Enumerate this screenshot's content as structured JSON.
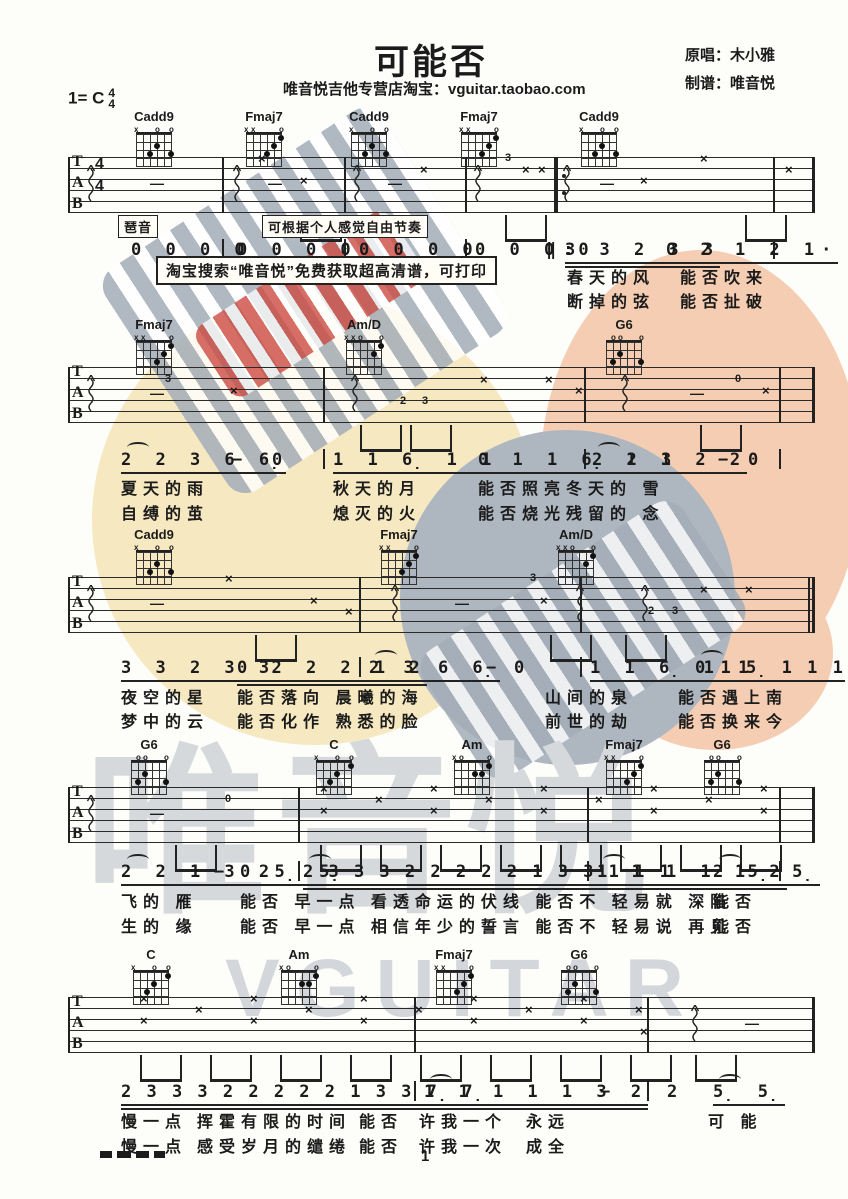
{
  "header": {
    "title": "可能否",
    "key_prefix": "1= C",
    "time_top": "4",
    "time_bottom": "4",
    "subtitle": "唯音悦吉他专营店淘宝：vguitar.taobao.com",
    "credit_singer": "原唱：木小雅",
    "credit_arranger": "制谱：唯音悦"
  },
  "labels": {
    "arpeggio": "琶音",
    "free_rhythm": "可根据个人感觉自由节奏",
    "banner": "淘宝搜索“唯音悦”免费获取超高清谱，可打印",
    "page_number": "1"
  },
  "watermark": {
    "cn": "唯音悦",
    "en": "VGUITAR",
    "colors": {
      "yellow": "#f6e8c0",
      "salmon": "#f5cdb2",
      "gray_circle": "#aeb6c0",
      "stripe": "#a3adb8",
      "red": "#cc4b42",
      "big_text": "#d6d9dc"
    }
  },
  "chord_defs": {
    "Cadd9": {
      "markers": [
        "x",
        "",
        "",
        "o",
        "",
        "o"
      ],
      "dots": [
        [
          2,
          3
        ],
        [
          3,
          2
        ],
        [
          5,
          3
        ]
      ]
    },
    "Fmaj7": {
      "markers": [
        "x",
        "x",
        "",
        "",
        "",
        "o"
      ],
      "dots": [
        [
          3,
          3
        ],
        [
          4,
          2
        ],
        [
          5,
          1
        ]
      ]
    },
    "Am/D": {
      "markers": [
        "x",
        "x",
        "o",
        "",
        "",
        "o"
      ],
      "dots": [
        [
          4,
          2
        ],
        [
          5,
          1
        ]
      ]
    },
    "G6": {
      "markers": [
        "",
        "o",
        "o",
        "",
        "",
        "o"
      ],
      "dots": [
        [
          1,
          3
        ],
        [
          2,
          2
        ],
        [
          5,
          3
        ]
      ]
    },
    "C": {
      "markers": [
        "x",
        "",
        "",
        "o",
        "",
        "o"
      ],
      "dots": [
        [
          2,
          3
        ],
        [
          3,
          2
        ],
        [
          5,
          1
        ]
      ]
    },
    "Am": {
      "markers": [
        "x",
        "o",
        "",
        "",
        "",
        "o"
      ],
      "dots": [
        [
          3,
          2
        ],
        [
          4,
          2
        ],
        [
          5,
          1
        ]
      ]
    }
  },
  "systems": [
    {
      "chordTop": 110,
      "staffTop": 157,
      "numTop": 240,
      "lyrTop1": 264,
      "lyrTop2": 288,
      "timeSig": true,
      "chords": [
        {
          "n": "Cadd9",
          "x": 130
        },
        {
          "n": "Fmaj7",
          "x": 240
        },
        {
          "n": "Cadd9",
          "x": 345
        },
        {
          "n": "Fmaj7",
          "x": 455
        },
        {
          "n": "Cadd9",
          "x": 575
        }
      ],
      "bars": [
        68,
        222,
        344,
        465,
        773
      ],
      "endX": 812,
      "repeatX": 554,
      "marks": [
        {
          "t": "sq",
          "x": 86
        },
        {
          "t": "sq",
          "x": 232
        },
        {
          "t": "sq",
          "x": 352
        },
        {
          "t": "sq",
          "x": 473
        },
        {
          "t": "sq",
          "x": 562
        },
        {
          "t": "x",
          "x": 258,
          "l": 0
        },
        {
          "t": "x",
          "x": 300,
          "l": 2
        },
        {
          "t": "d",
          "x": 150,
          "l": 2
        },
        {
          "t": "d",
          "x": 268,
          "l": 2
        },
        {
          "t": "d",
          "x": 388,
          "l": 2
        },
        {
          "t": "x",
          "x": 420,
          "l": 1
        },
        {
          "t": "g",
          "x": 505,
          "l": 0,
          "v": "3"
        },
        {
          "t": "x",
          "x": 522,
          "l": 1
        },
        {
          "t": "x",
          "x": 538,
          "l": 1
        },
        {
          "t": "d",
          "x": 600,
          "l": 2
        },
        {
          "t": "x",
          "x": 640,
          "l": 2
        },
        {
          "t": "x",
          "x": 700,
          "l": 0
        },
        {
          "t": "x",
          "x": 785,
          "l": 1
        }
      ],
      "beams": [
        300,
        505,
        745
      ],
      "numBars": [
        222,
        344,
        465,
        773
      ],
      "groups": [
        {
          "x": 131,
          "t": "0 0 0 0"
        },
        {
          "x": 237,
          "t": "0 0 0 0"
        },
        {
          "x": 359,
          "t": "0 0 0 0"
        },
        {
          "x": 475,
          "t": "0 0 0 0"
        },
        {
          "x": 546,
          "t": "‖:"
        },
        {
          "x": 565,
          "t": "3 3 2 3 3",
          "u": 2
        },
        {
          "x": 666,
          "t": "0 2 1 2 1·",
          "u": 1
        }
      ],
      "lyr1": [
        {
          "x": 567,
          "t": "春天的风"
        },
        {
          "x": 680,
          "t": "能否吹来"
        }
      ],
      "lyr2": [
        {
          "x": 567,
          "t": "断掉的弦"
        },
        {
          "x": 680,
          "t": "能否扯破"
        }
      ]
    },
    {
      "chordTop": 318,
      "staffTop": 367,
      "numTop": 450,
      "lyrTop1": 475,
      "lyrTop2": 500,
      "chords": [
        {
          "n": "Fmaj7",
          "x": 130
        },
        {
          "n": "Am/D",
          "x": 340
        },
        {
          "n": "G6",
          "x": 600
        }
      ],
      "bars": [
        68,
        323,
        584,
        779
      ],
      "endX": 812,
      "marks": [
        {
          "t": "sq",
          "x": 86
        },
        {
          "t": "g",
          "x": 165,
          "l": 1,
          "v": "3"
        },
        {
          "t": "d",
          "x": 150,
          "l": 2
        },
        {
          "t": "x",
          "x": 230,
          "l": 2
        },
        {
          "t": "sq",
          "x": 350
        },
        {
          "t": "g",
          "x": 400,
          "l": 3,
          "v": "2"
        },
        {
          "t": "g",
          "x": 422,
          "l": 3,
          "v": "3"
        },
        {
          "t": "x",
          "x": 480,
          "l": 1
        },
        {
          "t": "x",
          "x": 545,
          "l": 1
        },
        {
          "t": "x",
          "x": 575,
          "l": 2
        },
        {
          "t": "sq",
          "x": 620
        },
        {
          "t": "d",
          "x": 690,
          "l": 2
        },
        {
          "t": "g",
          "x": 735,
          "l": 1,
          "v": "0"
        },
        {
          "t": "x",
          "x": 762,
          "l": 2
        }
      ],
      "beams": [
        360,
        410,
        700
      ],
      "numBars": [
        323,
        584,
        779
      ],
      "groups": [
        {
          "x": 121,
          "t": "2 2 3 6 6̣",
          "u": 1,
          "arc": true
        },
        {
          "x": 232,
          "t": "−"
        },
        {
          "x": 272,
          "t": "0"
        },
        {
          "x": 333,
          "t": "1 1 6̣ 1 1",
          "u": 1
        },
        {
          "x": 478,
          "t": "0 1 1 6̣ 1 1",
          "u": 1
        },
        {
          "x": 592,
          "t": "2 2 3 2 2",
          "u": 1,
          "arc": true
        },
        {
          "x": 718,
          "t": "−"
        },
        {
          "x": 748,
          "t": "0"
        }
      ],
      "lyr1": [
        {
          "x": 121,
          "t": "夏天的雨"
        },
        {
          "x": 333,
          "t": "秋天的月"
        },
        {
          "x": 478,
          "t": "能否照亮冬天的 雪"
        }
      ],
      "lyr2": [
        {
          "x": 121,
          "t": "自缚的茧"
        },
        {
          "x": 333,
          "t": "熄灭的火"
        },
        {
          "x": 478,
          "t": "能否烧光残留的 念"
        }
      ]
    },
    {
      "chordTop": 528,
      "staffTop": 577,
      "numTop": 658,
      "lyrTop1": 684,
      "lyrTop2": 708,
      "chords": [
        {
          "n": "Cadd9",
          "x": 130
        },
        {
          "n": "Fmaj7",
          "x": 375
        },
        {
          "n": "Am/D",
          "x": 552
        }
      ],
      "bars": [
        68,
        359,
        580,
        808
      ],
      "endX": 812,
      "marks": [
        {
          "t": "sq",
          "x": 86
        },
        {
          "t": "d",
          "x": 150,
          "l": 2
        },
        {
          "t": "x",
          "x": 225,
          "l": 0
        },
        {
          "t": "x",
          "x": 310,
          "l": 2
        },
        {
          "t": "x",
          "x": 345,
          "l": 3
        },
        {
          "t": "sq",
          "x": 390
        },
        {
          "t": "d",
          "x": 455,
          "l": 2
        },
        {
          "t": "g",
          "x": 530,
          "l": 0,
          "v": "3"
        },
        {
          "t": "x",
          "x": 540,
          "l": 2
        },
        {
          "t": "sq",
          "x": 575
        },
        {
          "t": "sq",
          "x": 640
        },
        {
          "t": "g",
          "x": 648,
          "l": 3,
          "v": "2"
        },
        {
          "t": "g",
          "x": 672,
          "l": 3,
          "v": "3"
        },
        {
          "t": "x",
          "x": 700,
          "l": 1
        },
        {
          "t": "x",
          "x": 745,
          "l": 1
        }
      ],
      "beams": [
        255,
        550,
        625
      ],
      "numBars": [
        359,
        580
      ],
      "groups": [
        {
          "x": 121,
          "t": "3 3 2 3 3",
          "u": 1
        },
        {
          "x": 237,
          "t": "0 2 2 2 1 2",
          "u": 2
        },
        {
          "x": 369,
          "t": "2 3 6 6̣",
          "u": 1,
          "arc": true
        },
        {
          "x": 486,
          "t": "−"
        },
        {
          "x": 514,
          "t": "0"
        },
        {
          "x": 590,
          "t": "1 1 6̣ 1 1",
          "u": 1
        },
        {
          "x": 695,
          "t": "0 1 5̣ 1 1 1",
          "u": 1,
          "tight": true,
          "arc": true
        }
      ],
      "lyr1": [
        {
          "x": 121,
          "t": "夜空的星"
        },
        {
          "x": 237,
          "t": "能否落向 晨曦的海"
        },
        {
          "x": 545,
          "t": "山间的泉"
        },
        {
          "x": 678,
          "t": "能否遇上南"
        }
      ],
      "lyr2": [
        {
          "x": 121,
          "t": "梦中的云"
        },
        {
          "x": 237,
          "t": "能否化作 熟悉的脸"
        },
        {
          "x": 545,
          "t": "前世的劫"
        },
        {
          "x": 678,
          "t": "能否换来今"
        }
      ]
    },
    {
      "chordTop": 738,
      "staffTop": 787,
      "numTop": 862,
      "lyrTop1": 888,
      "lyrTop2": 913,
      "chords": [
        {
          "n": "G6",
          "x": 125
        },
        {
          "n": "C",
          "x": 310
        },
        {
          "n": "Am",
          "x": 448
        },
        {
          "n": "Fmaj7",
          "x": 600
        },
        {
          "n": "G6",
          "x": 698
        }
      ],
      "bars": [
        68,
        298,
        587,
        779
      ],
      "endX": 812,
      "marks": [
        {
          "t": "sq",
          "x": 86
        },
        {
          "t": "d",
          "x": 150,
          "l": 2
        },
        {
          "t": "g",
          "x": 225,
          "l": 1,
          "v": "0"
        },
        {
          "t": "x",
          "x": 320,
          "l": 0
        },
        {
          "t": "x",
          "x": 320,
          "l": 2
        },
        {
          "t": "x",
          "x": 375,
          "l": 1
        },
        {
          "t": "x",
          "x": 430,
          "l": 0
        },
        {
          "t": "x",
          "x": 430,
          "l": 2
        },
        {
          "t": "x",
          "x": 485,
          "l": 1
        },
        {
          "t": "x",
          "x": 540,
          "l": 0
        },
        {
          "t": "x",
          "x": 540,
          "l": 2
        },
        {
          "t": "x",
          "x": 595,
          "l": 1
        },
        {
          "t": "x",
          "x": 650,
          "l": 0
        },
        {
          "t": "x",
          "x": 650,
          "l": 2
        },
        {
          "t": "x",
          "x": 705,
          "l": 1
        },
        {
          "t": "x",
          "x": 760,
          "l": 0
        },
        {
          "t": "x",
          "x": 760,
          "l": 2
        }
      ],
      "beams": [
        175,
        320,
        380,
        440,
        500,
        560,
        620,
        680,
        740
      ],
      "numBars": [
        298,
        587,
        779
      ],
      "groups": [
        {
          "x": 121,
          "t": "2 2 1 3 2",
          "u": 1,
          "arc": true
        },
        {
          "x": 214,
          "t": "−"
        },
        {
          "x": 240,
          "t": "0 5̣ 5̣",
          "u": 1
        },
        {
          "x": 303,
          "t": "2 3 3 3 2 2 2 2 2 1 3 3 1 1 1",
          "u": 2,
          "tight": true,
          "arc": true
        },
        {
          "x": 597,
          "t": "1 1 1 1 1 2",
          "u": 2,
          "arc": true
        },
        {
          "x": 713,
          "t": "2 5̣ 5̣",
          "u": 1,
          "arc": true
        }
      ],
      "lyr1": [
        {
          "x": 121,
          "t": "飞的 雁"
        },
        {
          "x": 240,
          "t": "能否 早一点 看透命运的伏线 能否不 轻易就 深陷"
        },
        {
          "x": 713,
          "t": "能否"
        }
      ],
      "lyr2": [
        {
          "x": 121,
          "t": "生的 缘"
        },
        {
          "x": 240,
          "t": "能否 早一点 相信年少的誓言 能否不 轻易说 再见"
        },
        {
          "x": 713,
          "t": "能否"
        }
      ]
    },
    {
      "chordTop": 948,
      "staffTop": 997,
      "numTop": 1082,
      "lyrTop1": 1108,
      "lyrTop2": 1133,
      "chords": [
        {
          "n": "C",
          "x": 127
        },
        {
          "n": "Am",
          "x": 275
        },
        {
          "n": "Fmaj7",
          "x": 430
        },
        {
          "n": "G6",
          "x": 555
        }
      ],
      "bars": [
        68,
        414,
        647
      ],
      "endX": 812,
      "marks": [
        {
          "t": "x",
          "x": 140,
          "l": 0
        },
        {
          "t": "x",
          "x": 140,
          "l": 2
        },
        {
          "t": "x",
          "x": 195,
          "l": 1
        },
        {
          "t": "x",
          "x": 250,
          "l": 0
        },
        {
          "t": "x",
          "x": 250,
          "l": 2
        },
        {
          "t": "x",
          "x": 305,
          "l": 1
        },
        {
          "t": "x",
          "x": 360,
          "l": 0
        },
        {
          "t": "x",
          "x": 360,
          "l": 2
        },
        {
          "t": "x",
          "x": 415,
          "l": 1
        },
        {
          "t": "x",
          "x": 470,
          "l": 0
        },
        {
          "t": "x",
          "x": 470,
          "l": 2
        },
        {
          "t": "x",
          "x": 525,
          "l": 1
        },
        {
          "t": "x",
          "x": 580,
          "l": 0
        },
        {
          "t": "x",
          "x": 580,
          "l": 2
        },
        {
          "t": "x",
          "x": 635,
          "l": 1
        },
        {
          "t": "x",
          "x": 640,
          "l": 3
        },
        {
          "t": "sq",
          "x": 690
        },
        {
          "t": "d",
          "x": 745,
          "l": 2
        }
      ],
      "beams": [
        140,
        210,
        280,
        350,
        420,
        490,
        560,
        630,
        695
      ],
      "numBars": [
        414,
        647
      ],
      "groups": [
        {
          "x": 121,
          "t": "2 3 3 3 2 2 2 2 2 1 3 3 7̣ 7̣",
          "u": 2,
          "tight": true
        },
        {
          "x": 424,
          "t": "1 1 1 1 1 3 2",
          "u": 2,
          "arc": true
        },
        {
          "x": 600,
          "t": "−"
        },
        {
          "x": 667,
          "t": "2"
        },
        {
          "x": 713,
          "t": "5̣ 5̣",
          "u": 1,
          "arc": true
        }
      ],
      "lyr1": [
        {
          "x": 121,
          "t": "慢一点"
        },
        {
          "x": 197,
          "t": "挥霍有限的时间"
        },
        {
          "x": 359,
          "t": "能否"
        },
        {
          "x": 419,
          "t": "许我一个"
        },
        {
          "x": 526,
          "t": "永远"
        },
        {
          "x": 708,
          "t": "可 能"
        }
      ],
      "lyr2": [
        {
          "x": 121,
          "t": "慢一点"
        },
        {
          "x": 197,
          "t": "感受岁月的缱绻"
        },
        {
          "x": 359,
          "t": "能否"
        },
        {
          "x": 419,
          "t": "许我一次"
        },
        {
          "x": 526,
          "t": "成全"
        }
      ]
    }
  ]
}
